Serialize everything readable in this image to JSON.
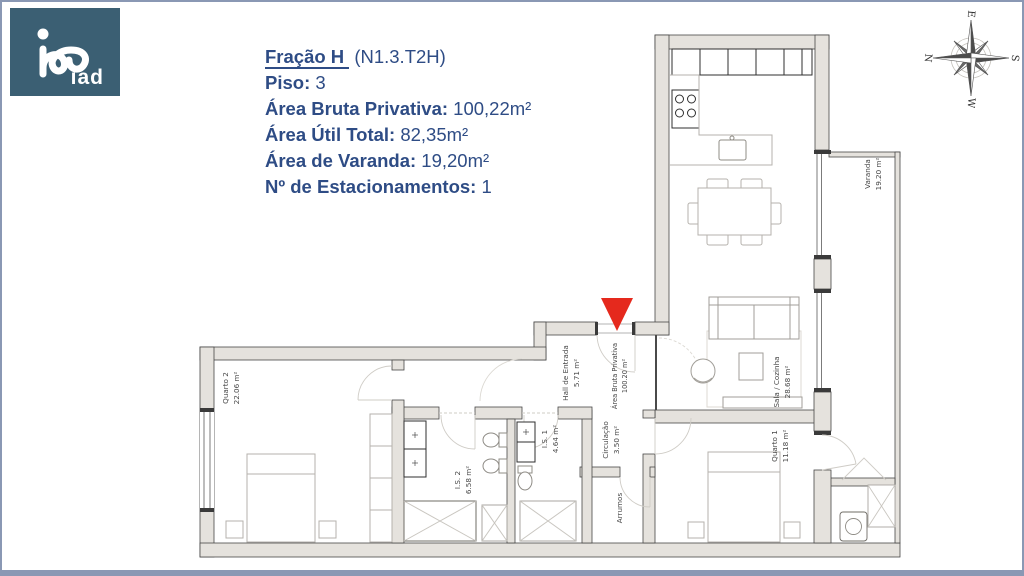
{
  "frame": {
    "border_color": "#8a98b4"
  },
  "logo": {
    "brand": "iad",
    "bg_color": "#3b5f73"
  },
  "header": {
    "text_color": "#2e4c85",
    "title": {
      "name": "Fração H",
      "code": "(N1.3.T2H)"
    },
    "specs": [
      {
        "label": "Piso:",
        "value": "3"
      },
      {
        "label": "Área Bruta Privativa:",
        "value": "100,22m²"
      },
      {
        "label": "Área Útil Total:",
        "value": "82,35m²"
      },
      {
        "label": "Área de Varanda:",
        "value": "19,20m²"
      },
      {
        "label": "Nº de Estacionamentos:",
        "value": "1"
      }
    ]
  },
  "compass": {
    "n": "N",
    "e": "E",
    "s": "S",
    "w": "W"
  },
  "floorplan": {
    "entrance_marker_color": "#e5291d",
    "wall_color": "#e5e2dd",
    "rooms": [
      {
        "name": "Quarto 2",
        "area": "22.06 m²"
      },
      {
        "name": "I.S. 2",
        "area": "6.58 m²"
      },
      {
        "name": "I.S. 1",
        "area": "4.64 m²"
      },
      {
        "name": "Hall de Entrada",
        "area": "5.71 m²"
      },
      {
        "name": "Área Bruta Privativa",
        "area": "100.20 m²"
      },
      {
        "name": "Circulação",
        "area": "3.50 m²"
      },
      {
        "name": "Arrumos",
        "area": ""
      },
      {
        "name": "Quarto 1",
        "area": "11.18 m²"
      },
      {
        "name": "Sala / Cozinha",
        "area": "28.68 m²"
      },
      {
        "name": "Varanda",
        "area": "19.20 m²"
      }
    ]
  }
}
